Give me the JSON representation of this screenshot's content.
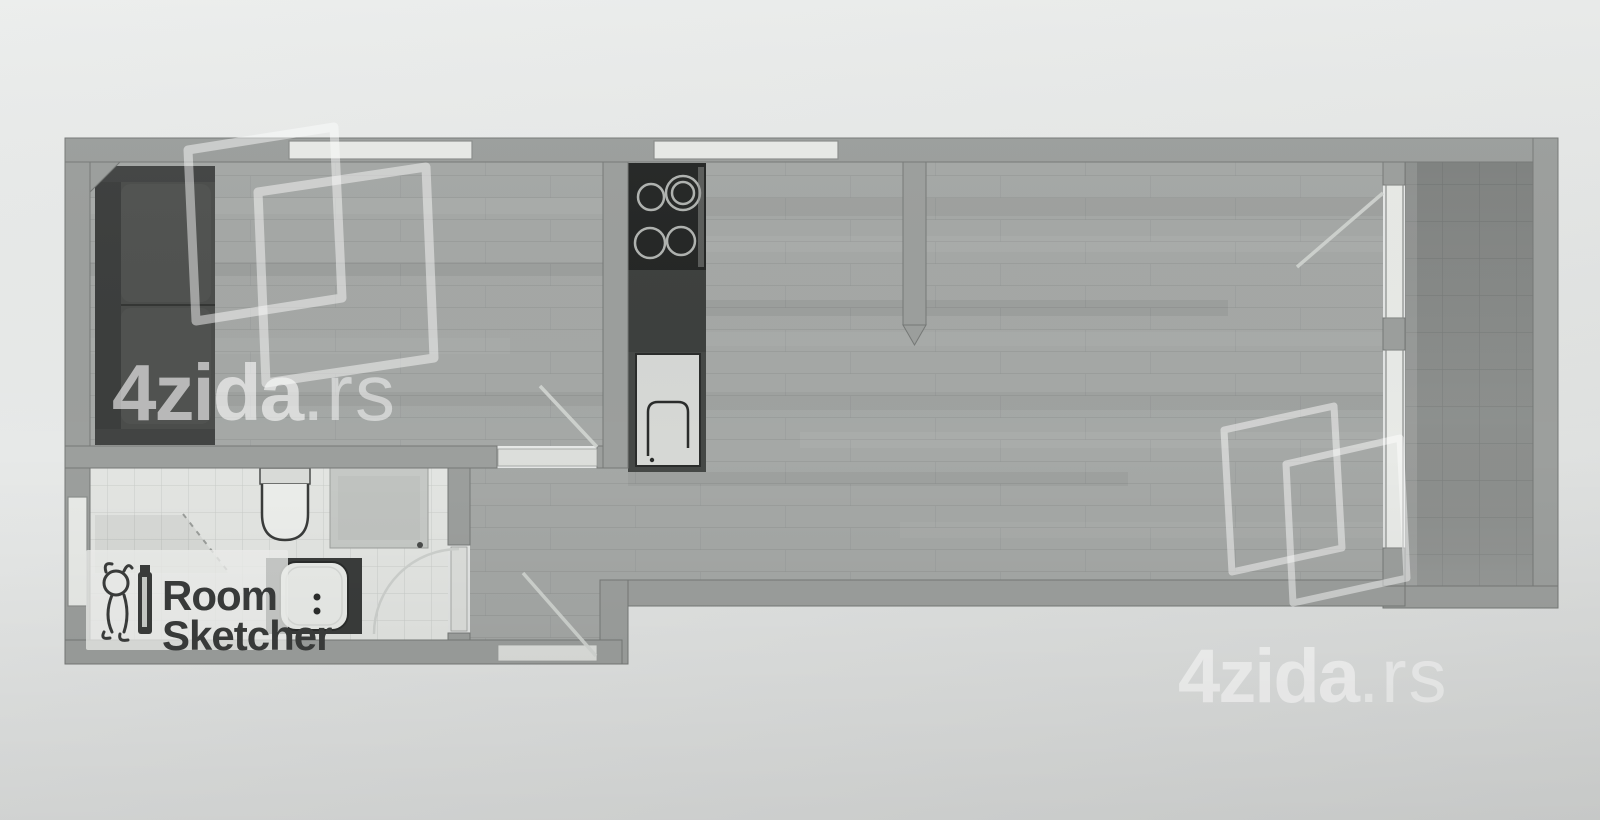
{
  "document": {
    "type": "floor-plan-photo",
    "description": "Scanned real-estate floor plan of a studio apartment with living room, bathroom, hallway, open kitchen/living area and terrace"
  },
  "watermark": {
    "brand_bold": "4zida",
    "brand_suffix": ".rs",
    "full": "4zida.rs",
    "color": "rgba(255,255,255,0.55)"
  },
  "branding": {
    "roomsketcher_line1": "Room",
    "roomsketcher_line2": "Sketcher",
    "text_color": "#3a3c3b"
  },
  "colors": {
    "page_background": "#e6e8e7",
    "wall": "#9c9f9d",
    "wood_floor": "#a5a8a6",
    "bathroom_floor": "#e3e5e2",
    "terrace_floor": "#8d908e",
    "window": "#e8eae7",
    "door_opening": "#dcdedb",
    "kitchen_dark": "#454846",
    "stove": "#242625",
    "sofa": "#4b4d4b",
    "shower": "#c6c9c6",
    "vanity": "#3a3c3b"
  },
  "plan": {
    "rooms": [
      "living-room",
      "bathroom",
      "hallway",
      "kitchen-living-area",
      "terrace"
    ],
    "fixtures": [
      "sofa",
      "stove-cooktop",
      "kitchen-sink",
      "toilet",
      "shower",
      "washbasin-vanity"
    ]
  }
}
